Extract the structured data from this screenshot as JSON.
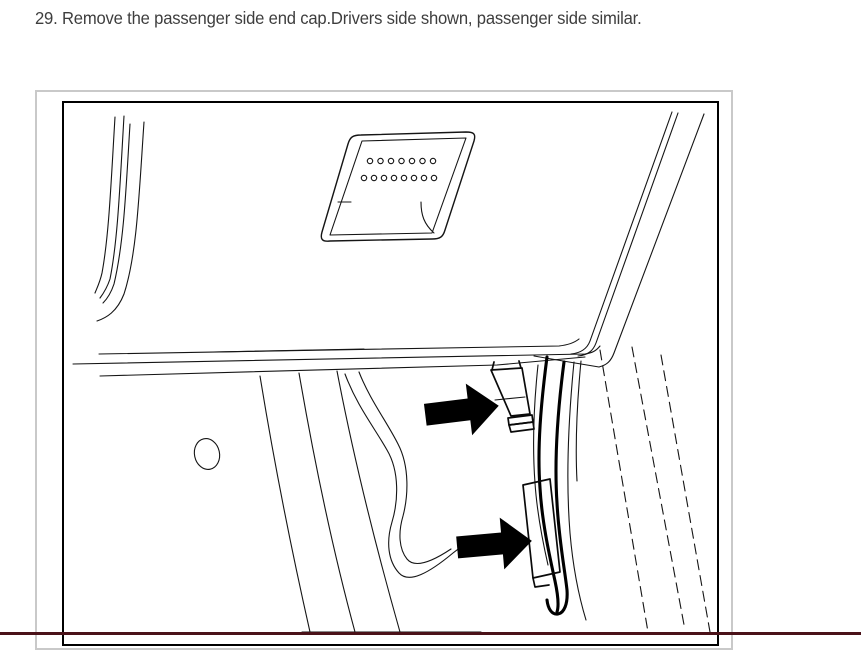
{
  "instruction": {
    "step_text": "29. Remove the passenger side end cap.Drivers side shown, passenger side similar."
  },
  "figure": {
    "alt": "Line drawing of driver side dash end with speaker grille, wire harness and end cap; two black arrows point to the end cap retaining clips",
    "arrows": [
      "upper-clip-pointer-arrow",
      "lower-clip-pointer-arrow"
    ],
    "colors": {
      "line": "#151515",
      "arrow_fill": "#000000",
      "inner_border": "#000000",
      "outer_border": "#c9c9c9"
    }
  },
  "page": {
    "background": "#ffffff",
    "text_color": "#3e3e3e",
    "bottom_edge_color": "#4a1118"
  }
}
